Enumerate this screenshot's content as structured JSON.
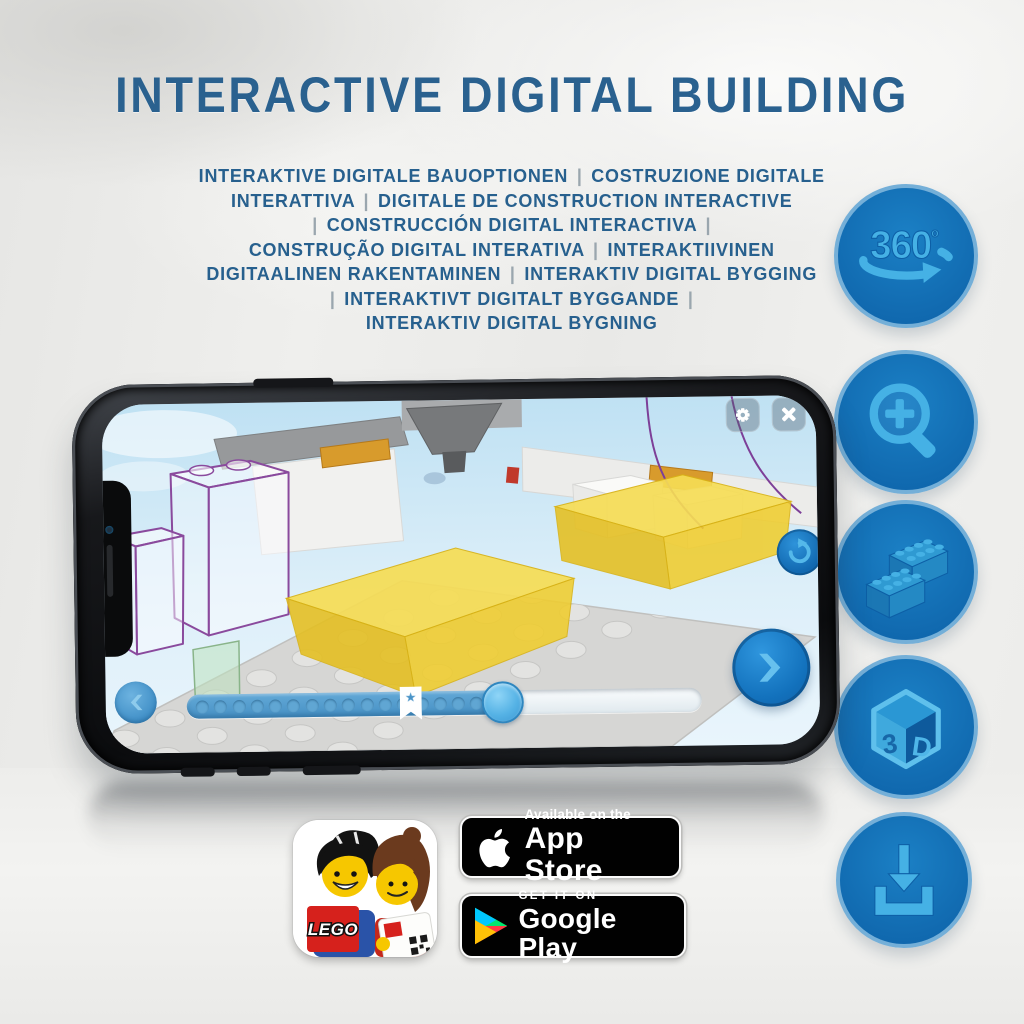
{
  "page": {
    "title": "INTERACTIVE DIGITAL BUILDING"
  },
  "subtitle": {
    "lines": [
      "INTERAKTIVE DIGITALE BAUOPTIONEN | COSTRUZIONE DIGITALE",
      "INTERATTIVA | DIGITALE DE CONSTRUCTION INTERACTIVE",
      "| CONSTRUCCIÓN DIGITAL INTERACTIVA |",
      "CONSTRUÇÃO DIGITAL INTERATIVA | INTERAKTIIVINEN",
      "DIGITAALINEN RAKENTAMINEN | INTERAKTIV DIGITAL BYGGING",
      "| INTERAKTIVT DIGITALT BYGGANDE |",
      "INTERAKTIV DIGITAL BYGNING"
    ]
  },
  "feature_column": {
    "icons": [
      {
        "id": "rotate-360",
        "label": "360",
        "degree": "º"
      },
      {
        "id": "zoom-in"
      },
      {
        "id": "bricks"
      },
      {
        "id": "view-3d",
        "left": "3",
        "right": "D"
      },
      {
        "id": "download"
      }
    ]
  },
  "phone": {
    "app": {
      "progress": {
        "dot_count": 17,
        "filled_ratio": 0.64
      }
    }
  },
  "badges": {
    "lego_app": {
      "logo_text": "LEGO"
    },
    "app_store": {
      "top": "Available on the",
      "bottom": "App Store"
    },
    "google_play": {
      "top": "GET IT ON",
      "bottom": "Google Play"
    }
  },
  "colors": {
    "title_blue": "#2a618f",
    "icon_circle_fill": "#1173b9",
    "icon_circle_rim": "#74afd8",
    "icon_glyph_blue": "#45b1e5",
    "slider_fill": "#4a94c8",
    "slider_handle": "#55b6e9",
    "brick_yellow": "#f2d22e",
    "brick_outline_purple": "#8a4a9d",
    "badge_background": "#010101"
  }
}
